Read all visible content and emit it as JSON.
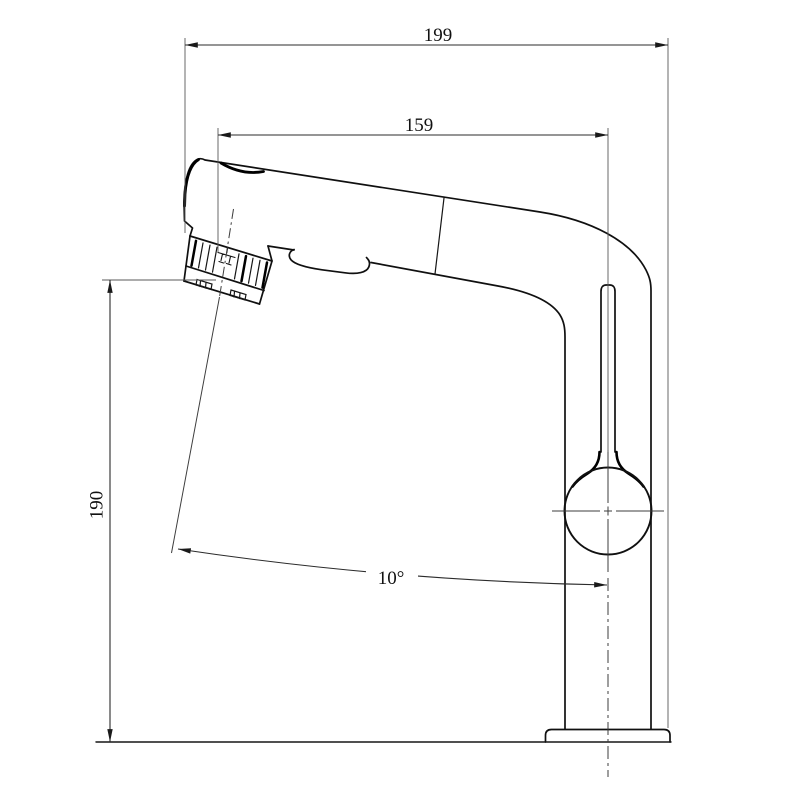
{
  "drawing": {
    "kind": "technical-dimension-drawing",
    "colors": {
      "background": "#ffffff",
      "object_line": "#101010",
      "dimension_line": "#2b2b2b",
      "extension_line": "#5a5a5a"
    },
    "dimensions": {
      "overall_width": {
        "value": "199"
      },
      "spout_reach": {
        "value": "159"
      },
      "height": {
        "value": "190"
      },
      "spray_angle": {
        "value": "10°"
      }
    },
    "icons": {
      "spray_face": "spray-nozzle-icon"
    }
  }
}
